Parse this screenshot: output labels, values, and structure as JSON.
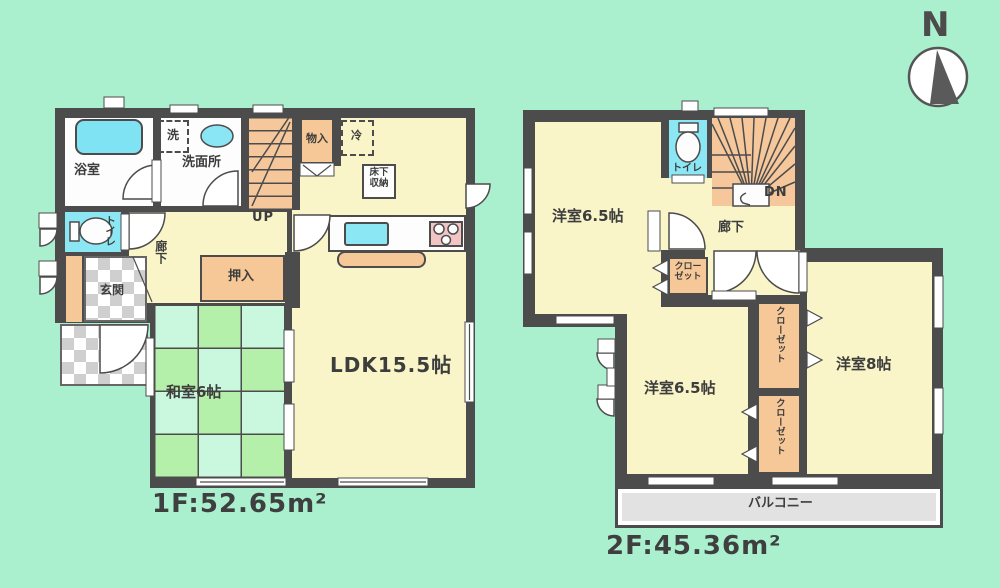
{
  "page": {
    "background": "#aaf0cf"
  },
  "compass": {
    "north_label": "N"
  },
  "floor1": {
    "area_label": "1F:52.65m²",
    "labels": {
      "bath": "浴室",
      "washroom": "洗面所",
      "laundry": "洗",
      "toilet": "トイレ",
      "hallway": "廊下",
      "entrance": "玄関",
      "closet_oshiire": "押入",
      "storage_monoire": "物入",
      "refrigerator": "冷",
      "floor_storage": "床下収納",
      "stairs_up": "UP",
      "japanese_room": "和室6帖",
      "ldk": "LDK15.5帖"
    }
  },
  "floor2": {
    "area_label": "2F:45.36m²",
    "labels": {
      "west_room_top": "洋室6.5帖",
      "toilet": "トイレ",
      "stairs_down": "DN",
      "hallway": "廊下",
      "closet_hall": "クローゼット",
      "west_room_left": "洋室6.5帖",
      "west_room_right": "洋室8帖",
      "closet_upper": "クローゼット",
      "closet_lower": "クローゼット",
      "balcony": "バルコニー"
    }
  },
  "colors": {
    "wall": "#4c4c4c",
    "room_yellow": "#f9f5c9",
    "tatami_green": "#b5f0aa",
    "tatami_mint": "#c9f8df",
    "fixture_orange": "#f6c897",
    "water_blue": "#8ce7f4",
    "background_mint": "#aaf0cf"
  }
}
